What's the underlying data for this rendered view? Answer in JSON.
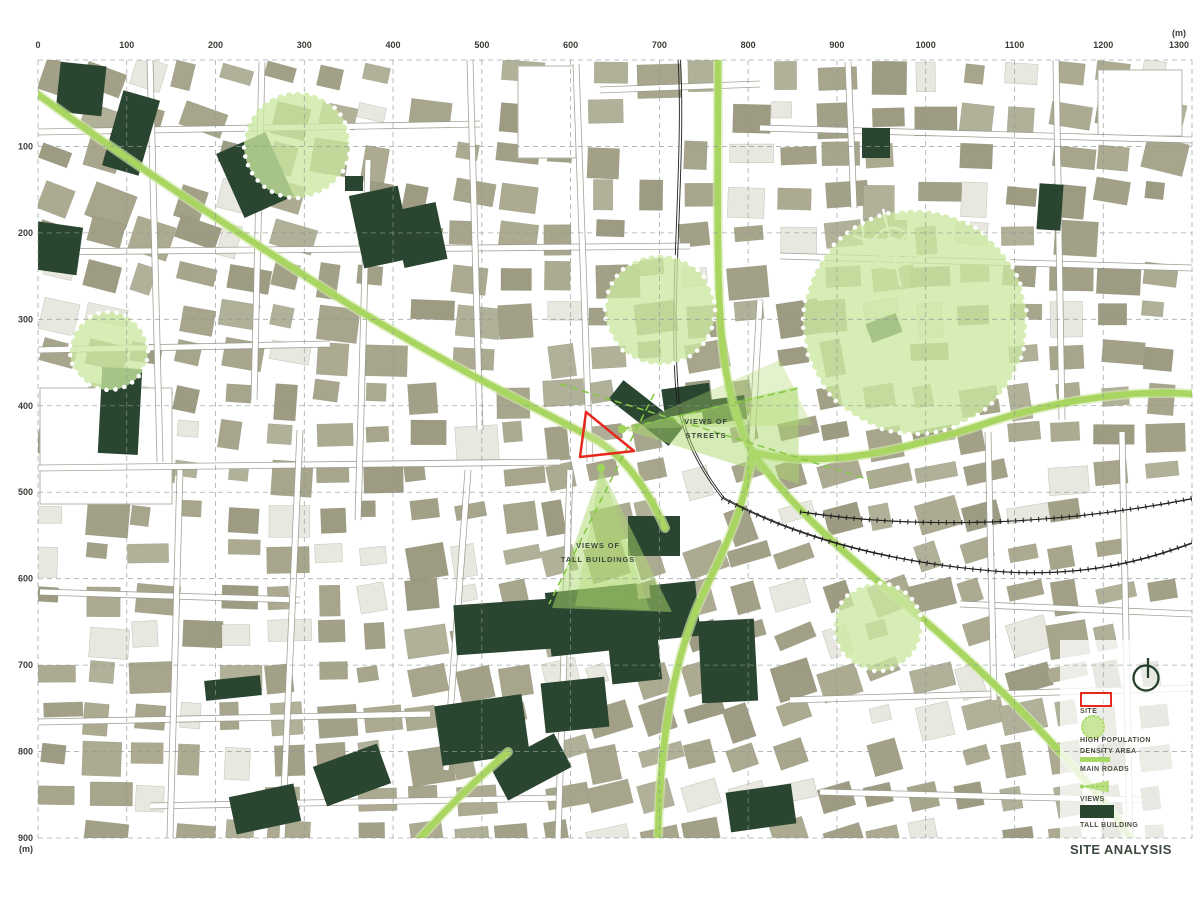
{
  "title": "SITE ANALYSIS",
  "rulers": {
    "unit_label": "(m)",
    "top_ticks": [
      "0",
      "100",
      "200",
      "300",
      "400",
      "500",
      "600",
      "700",
      "800",
      "900",
      "1000",
      "1100",
      "1200",
      "1300"
    ],
    "left_ticks": [
      "100",
      "200",
      "300",
      "400",
      "500",
      "600",
      "700",
      "800",
      "900"
    ]
  },
  "annotations": {
    "views_of_streets": {
      "lines": [
        "VIEWS OF",
        "STREETS"
      ],
      "x": 706,
      "y": 429
    },
    "views_of_tall_buildings": {
      "lines": [
        "VIEWS OF",
        "TALL BUILDINGS"
      ],
      "x": 598,
      "y": 553
    }
  },
  "legend": {
    "items": [
      {
        "id": "site",
        "label": "SITE"
      },
      {
        "id": "high-population-density-area",
        "lines": [
          "HIGH POPULATION",
          "DENSITY AREA"
        ]
      },
      {
        "id": "main-roads",
        "label": "MAIN ROADS"
      },
      {
        "id": "views",
        "label": "VIEWS"
      },
      {
        "id": "tall-building",
        "label": "TALL BUILDING"
      }
    ]
  },
  "colors": {
    "building": "#a6a58c",
    "building_light": "#e8e8e0",
    "tall_building": "#2a4530",
    "main_road": "#a8d660",
    "main_road_halo": "#d3eaab",
    "density_fill": "#cbe8a0",
    "site_outline": "#e8281c",
    "view_cone": "#aed96f",
    "view_dash": "#86c845",
    "railway": "#1f1f1f",
    "grid": "#8f9896",
    "ruler_text": "#3b3b36"
  },
  "map_features": {
    "map_area": {
      "x0": 38,
      "y0": 60,
      "x1": 1192,
      "y1": 838
    },
    "density_circles": [
      {
        "cx": 297,
        "cy": 145,
        "r": 53
      },
      {
        "cx": 109,
        "cy": 351,
        "r": 39
      },
      {
        "cx": 660,
        "cy": 310,
        "r": 55
      },
      {
        "cx": 915,
        "cy": 322,
        "r": 112
      },
      {
        "cx": 878,
        "cy": 627,
        "r": 44
      }
    ],
    "site_polygon": "586,412 580,457 634,451",
    "view_cones": [
      {
        "points": "622,429 798,386 799,484",
        "inner": "622,429 780,360 812,425",
        "dot": [
          622,
          429
        ],
        "dashes": [
          "M 560,384 L 870,480",
          "M 622,429 L 800,388"
        ]
      },
      {
        "points": "601,468 552,608 672,612",
        "inner": "601,468 575,606 650,610",
        "dot": [
          601,
          468
        ],
        "dashes": [
          "M 654,394 L 549,604"
        ]
      }
    ],
    "main_roads": [
      "M 32,90 C 140,170 250,240 345,302 C 460,373 545,412 596,440 C 625,457 648,490 665,528",
      "M 718,58 C 718,170 716,280 722,340 C 727,392 738,425 752,452",
      "M 752,452 C 820,470 900,452 990,422 C 1070,396 1145,390 1194,394",
      "M 752,452 C 790,505 840,550 898,598 C 975,662 1055,740 1118,820 L 1132,840",
      "M 752,452 C 745,515 718,560 698,605 C 676,658 660,730 658,838",
      "M 420,838 C 450,805 478,778 508,752"
    ],
    "railways": [
      "M 678,58 C 684,160 668,300 676,392 C 680,435 700,470 722,498",
      "M 722,498 C 810,545 910,565 1005,572 C 1095,577 1155,556 1194,542",
      "M 800,512 C 920,530 1060,525 1194,498"
    ],
    "tall_buildings": [
      [
        58,
        64,
        46,
        50,
        6
      ],
      [
        112,
        94,
        38,
        78,
        16
      ],
      [
        228,
        140,
        54,
        70,
        -24
      ],
      [
        345,
        176,
        18,
        15,
        0
      ],
      [
        356,
        190,
        50,
        74,
        -12
      ],
      [
        398,
        206,
        44,
        58,
        -12
      ],
      [
        30,
        224,
        50,
        48,
        8
      ],
      [
        100,
        368,
        40,
        86,
        3
      ],
      [
        608,
        401,
        76,
        24,
        38
      ],
      [
        663,
        386,
        48,
        28,
        -8
      ],
      [
        702,
        398,
        44,
        24,
        -8
      ],
      [
        628,
        516,
        52,
        40,
        0
      ],
      [
        455,
        602,
        95,
        50,
        -4
      ],
      [
        548,
        588,
        92,
        64,
        -6
      ],
      [
        608,
        600,
        50,
        82,
        -6
      ],
      [
        652,
        583,
        46,
        55,
        -6
      ],
      [
        438,
        700,
        88,
        60,
        -8
      ],
      [
        543,
        680,
        64,
        50,
        -6
      ],
      [
        700,
        620,
        56,
        82,
        -3
      ],
      [
        495,
        748,
        72,
        38,
        -28
      ],
      [
        728,
        788,
        66,
        40,
        -8
      ],
      [
        205,
        678,
        56,
        20,
        -6
      ],
      [
        318,
        754,
        68,
        42,
        -20
      ],
      [
        232,
        790,
        66,
        38,
        -12
      ],
      [
        862,
        128,
        28,
        30,
        0
      ],
      [
        1038,
        184,
        24,
        46,
        4
      ],
      [
        868,
        318,
        32,
        20,
        -20
      ]
    ],
    "tall_building_ellipse": {
      "cx": 410,
      "cy": 223,
      "rx": 15,
      "ry": 13
    },
    "north_symbol": {
      "cx": 1146,
      "cy": 678,
      "r": 13
    }
  }
}
